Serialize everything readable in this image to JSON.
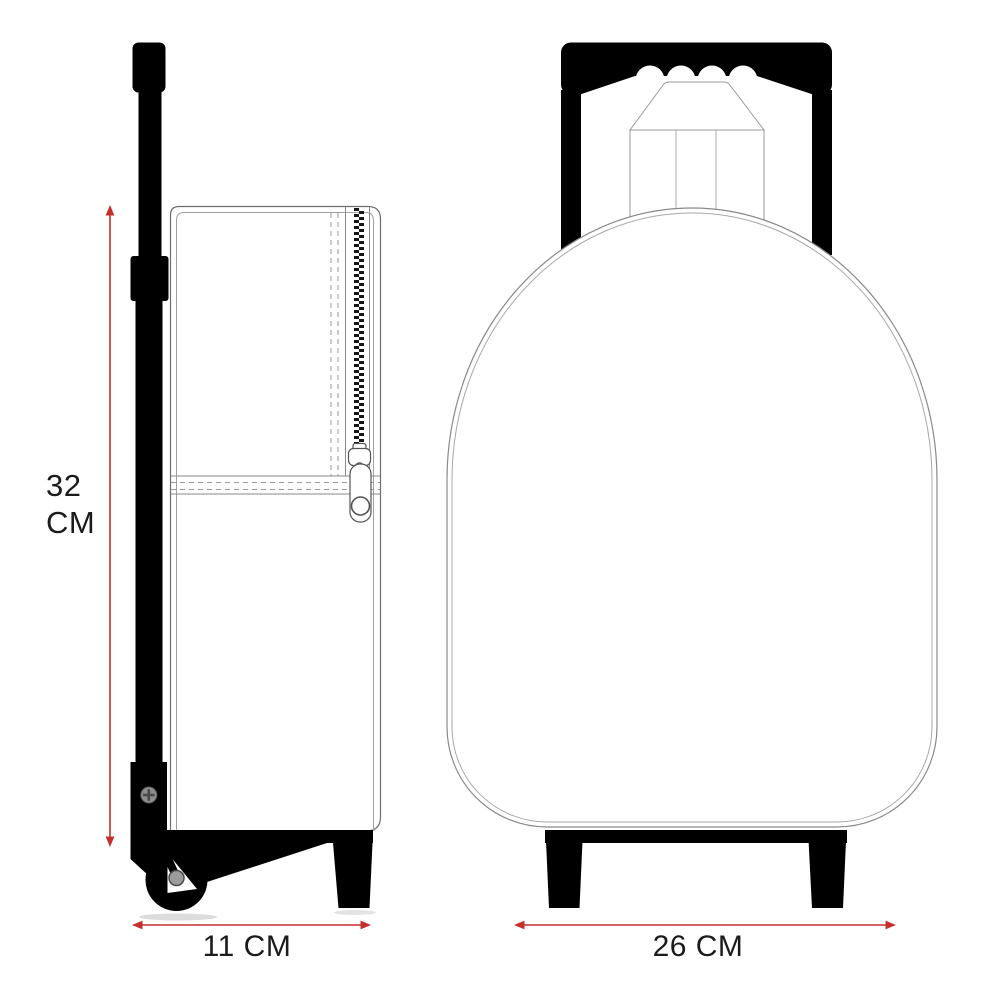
{
  "colors": {
    "accent_red": "#c5302c",
    "drawing_black": "#000000",
    "outline_gray": "#777777"
  },
  "dimensions": {
    "height": {
      "value": "32",
      "unit": "CM"
    },
    "depth": {
      "label": "11 CM"
    },
    "width": {
      "label": "26 CM"
    }
  }
}
